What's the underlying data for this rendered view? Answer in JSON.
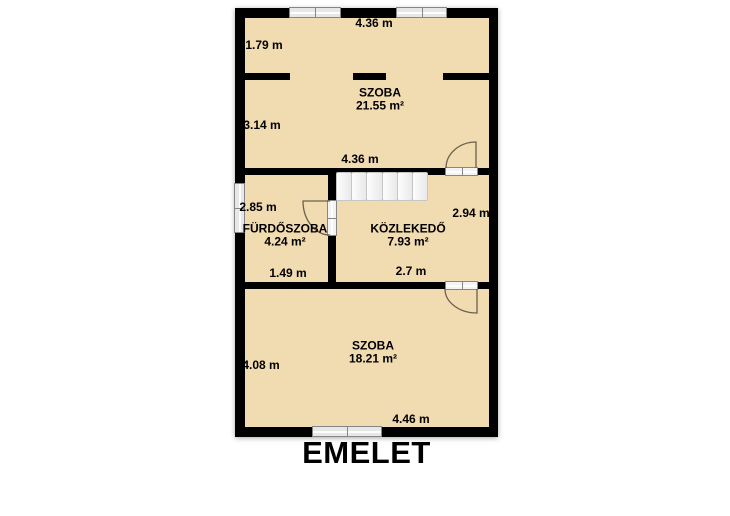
{
  "title": "EMELET",
  "floor_plan": {
    "rooms": {
      "szoba_top": {
        "name": "SZOBA",
        "area": "21.55 m²"
      },
      "furdoszoba": {
        "name": "FÜRDŐSZOBA",
        "area": "4.24 m²"
      },
      "kozlekedo": {
        "name": "KÖZLEKEDŐ",
        "area": "7.93 m²"
      },
      "szoba_bottom": {
        "name": "SZOBA",
        "area": "18.21 m²"
      }
    },
    "dimensions": {
      "top_width": "4.36 m",
      "attic_strip_height": "1.79 m",
      "szoba_top_height": "3.14 m",
      "szoba_top_width": "4.36 m",
      "furdoszoba_height": "2.85 m",
      "furdoszoba_width": "1.49 m",
      "kozlekedo_height": "2.94 m",
      "kozlekedo_width": "2.7 m",
      "szoba_bottom_height": "4.08 m",
      "szoba_bottom_width": "4.46 m"
    },
    "fixtures": {
      "window_count": 4,
      "door_count": 3,
      "stair_step_count": 6
    },
    "colors": {
      "floor": "#f1dbb1",
      "wall": "#000000",
      "fixture": "#e7e7e7",
      "door_arc": "#6d6050"
    }
  }
}
